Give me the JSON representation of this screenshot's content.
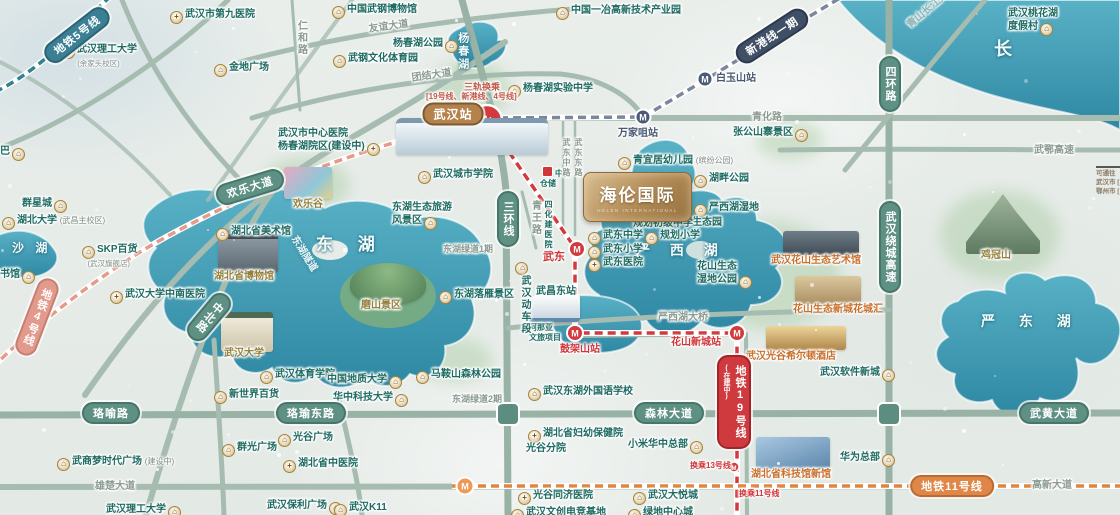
{
  "meta": {
    "width": 1120,
    "height": 515
  },
  "project_logo": {
    "name": "海伦国际",
    "subtitle": "HELEN INTERNATIONAL"
  },
  "legend": {
    "lines": [
      "可通往（",
      "武汉市 [",
      "鄂州市 ["
    ]
  },
  "lakes": [
    {
      "t": "东 湖",
      "x": 316,
      "y": 234,
      "sz": 17,
      "ls": 10
    },
    {
      "t": "沙 湖",
      "x": 12,
      "y": 241,
      "sz": 12,
      "ls": 4
    },
    {
      "t": "严 西 湖",
      "x": 636,
      "y": 242,
      "sz": 14,
      "ls": 8
    },
    {
      "t": "严 东 湖",
      "x": 981,
      "y": 313,
      "sz": 14,
      "ls": 10
    },
    {
      "t": "杨春湖",
      "x": 455,
      "y": 32,
      "sz": 11,
      "v": 1
    },
    {
      "t": "长",
      "x": 994,
      "y": 38,
      "sz": 18,
      "river": 1
    }
  ],
  "road_pills": [
    {
      "t": "欢乐大道",
      "x": 250,
      "y": 187,
      "r": -17
    },
    {
      "t": "三环线",
      "x": 508,
      "y": 219,
      "v": 1
    },
    {
      "t": "中北路",
      "x": 209,
      "y": 317,
      "v": 1,
      "r": 40
    },
    {
      "t": "珞喻路",
      "x": 111,
      "y": 413
    },
    {
      "t": "珞瑜东路",
      "x": 311,
      "y": 413
    },
    {
      "t": "森林大道",
      "x": 669,
      "y": 413
    },
    {
      "t": "武黄大道",
      "x": 1054,
      "y": 413
    },
    {
      "t": "四环路",
      "x": 890,
      "y": 84,
      "v": 1
    },
    {
      "t": "武汉绕城高速",
      "x": 890,
      "y": 247,
      "v": 1
    }
  ],
  "road_labels": [
    {
      "t": "友谊大道",
      "x": 368,
      "y": 24,
      "r": -8
    },
    {
      "t": "团结大道",
      "x": 411,
      "y": 73,
      "r": -8
    },
    {
      "t": "青化路",
      "x": 752,
      "y": 112
    },
    {
      "t": "仁和路",
      "x": 294,
      "y": 20,
      "v": 1
    },
    {
      "t": "青王路",
      "x": 528,
      "y": 200,
      "v": 1
    },
    {
      "t": "武东中路",
      "x": 561,
      "y": 138,
      "v": 1,
      "sz": 8
    },
    {
      "t": "武东东路",
      "x": 573,
      "y": 138,
      "v": 1,
      "sz": 8
    },
    {
      "t": "东湖绿道1期",
      "x": 443,
      "y": 244,
      "sz": 9
    },
    {
      "t": "东湖绿道2期",
      "x": 452,
      "y": 394,
      "sz": 9
    },
    {
      "t": "雄楚大道",
      "x": 95,
      "y": 481
    },
    {
      "t": "高新大道",
      "x": 1032,
      "y": 480
    },
    {
      "t": "武鄂高速",
      "x": 1034,
      "y": 145
    },
    {
      "t": "严西湖大桥",
      "x": 658,
      "y": 312
    },
    {
      "t": "青山长江大桥",
      "x": 905,
      "y": 22,
      "r": -40,
      "faint": 1
    },
    {
      "t": "东湖隧道",
      "x": 298,
      "y": 234,
      "r": 58,
      "tunnel": 1
    }
  ],
  "metro": {
    "line_pills": [
      {
        "t": "地铁5号线",
        "x": 77,
        "y": 35,
        "r": -38,
        "line": "l5"
      },
      {
        "t": "地铁4号线",
        "x": 37,
        "y": 317,
        "v": 1,
        "r": 21,
        "line": "l4"
      },
      {
        "t": "新港线一期",
        "x": 772,
        "y": 36,
        "r": -33,
        "line": "xg"
      },
      {
        "t": "地铁19号线",
        "sub": "(在建中)",
        "x": 734,
        "y": 402,
        "v": 1,
        "line": "l19"
      },
      {
        "t": "地铁11号线",
        "x": 952,
        "y": 486,
        "line": "l11"
      }
    ],
    "rail_station_pill": {
      "t": "武汉站",
      "x": 453,
      "y": 114
    },
    "transfer_note": {
      "t": "三轨换乘",
      "x": 464,
      "y": 82,
      "sub": "[19号线、新港线、4号线]",
      "sx": 426,
      "sy": 92
    },
    "stations": [
      {
        "t": "万家咀站",
        "x": 618,
        "y": 128,
        "c": "n"
      },
      {
        "t": "白玉山站",
        "x": 716,
        "y": 73,
        "c": "n"
      },
      {
        "t": "武东",
        "x": 543,
        "y": 251,
        "c": "r",
        "sz": 11
      },
      {
        "t": "鼓架山站",
        "x": 560,
        "y": 344,
        "c": "r"
      },
      {
        "t": "花山新城站",
        "x": 671,
        "y": 337,
        "c": "r"
      },
      {
        "t": "换乘13号线",
        "x": 690,
        "y": 461,
        "c": "r",
        "sz": 8
      },
      {
        "t": "换乘11号线",
        "x": 739,
        "y": 489,
        "c": "r",
        "sz": 8
      }
    ]
  },
  "pois": [
    {
      "t": "武汉市第九医院",
      "x": 168,
      "y": 9,
      "i": "h"
    },
    {
      "t": "武汉理工大学",
      "s": "(余家头校区)",
      "x": 60,
      "y": 44,
      "i": "b"
    },
    {
      "t": "金地广场",
      "x": 212,
      "y": 62,
      "i": "b"
    },
    {
      "t": "中国武钢博物馆",
      "x": 330,
      "y": 4,
      "i": "b"
    },
    {
      "t": "杨春湖公园",
      "x": 393,
      "y": 38,
      "i": "rb"
    },
    {
      "t": "武钢文化体育园",
      "x": 331,
      "y": 53,
      "i": "b"
    },
    {
      "t": "中国一冶高新技术产业园",
      "x": 554,
      "y": 5,
      "i": "b"
    },
    {
      "t": "杨春湖实验中学",
      "x": 506,
      "y": 83,
      "i": "b"
    },
    {
      "t": "张公山寨景区",
      "x": 733,
      "y": 127,
      "i": "rb"
    },
    {
      "t": "青宜居幼儿园",
      "suf": "(缤纷公园)",
      "x": 616,
      "y": 155,
      "i": "b"
    },
    {
      "t": "湖畔公园",
      "x": 692,
      "y": 173,
      "i": "b"
    },
    {
      "lines": [
        "严西湖湿地",
        "生态园"
      ],
      "x": 692,
      "y": 202,
      "i": "b"
    },
    {
      "t": "武东中学",
      "x": 586,
      "y": 230,
      "i": "b"
    },
    {
      "t": "规划小学",
      "x": 643,
      "y": 230,
      "i": "b"
    },
    {
      "t": "武东小学",
      "x": 586,
      "y": 244,
      "i": "b"
    },
    {
      "t": "武东医院",
      "x": 586,
      "y": 257,
      "i": "h"
    },
    {
      "t": "规划初级中学",
      "x": 633,
      "y": 218,
      "i": "n"
    },
    {
      "lines": [
        "花山生态",
        "湿地公园"
      ],
      "x": 697,
      "y": 261,
      "i": "rb"
    },
    {
      "t": "武汉花山生态艺术馆",
      "x": 771,
      "y": 255,
      "c": "o",
      "i": "n"
    },
    {
      "t": "花山生态新城花城汇",
      "x": 793,
      "y": 304,
      "c": "o",
      "i": "n"
    },
    {
      "t": "武汉光谷希尔顿酒店",
      "x": 746,
      "y": 351,
      "c": "o",
      "i": "n"
    },
    {
      "t": "武汉软件新城",
      "x": 820,
      "y": 367,
      "i": "rb"
    },
    {
      "t": "华为总部",
      "x": 840,
      "y": 452,
      "i": "rb"
    },
    {
      "t": "鸡冠山",
      "x": 981,
      "y": 250,
      "c": "g",
      "i": "n"
    },
    {
      "lines": [
        "武汉桃花湖",
        "度假村"
      ],
      "x": 1008,
      "y": 8,
      "i": "rb"
    },
    {
      "t": "群星城",
      "x": 22,
      "y": 198,
      "i": "rb"
    },
    {
      "t": "湖北大学",
      "suf": "(武昌主校区)",
      "x": 0,
      "y": 215,
      "i": "b"
    },
    {
      "t": "SKP百货",
      "s": "(武汉旗舰店)",
      "x": 80,
      "y": 244,
      "i": "b"
    },
    {
      "t": "武汉大学中南医院",
      "x": 108,
      "y": 289,
      "i": "h"
    },
    {
      "t": "湖北省美术馆",
      "x": 214,
      "y": 226,
      "i": "b"
    },
    {
      "t": "湖北省博物馆",
      "x": 214,
      "y": 271,
      "c": "g",
      "i": "n"
    },
    {
      "t": "武汉大学",
      "x": 224,
      "y": 348,
      "c": "g",
      "i": "n"
    },
    {
      "t": "欢乐谷",
      "x": 293,
      "y": 199,
      "c": "g",
      "i": "n"
    },
    {
      "t": "武汉城市学院",
      "x": 416,
      "y": 169,
      "i": "b"
    },
    {
      "lines": [
        "东湖生态旅游",
        "风景区"
      ],
      "x": 392,
      "y": 202,
      "i": "rb"
    },
    {
      "t": "东湖落雁景区",
      "x": 437,
      "y": 289,
      "i": "b"
    },
    {
      "t": "磨山景区",
      "x": 361,
      "y": 300,
      "c": "g",
      "i": "n"
    },
    {
      "t": "书馆",
      "x": 0,
      "y": 269,
      "i": "rb"
    },
    {
      "t": "巴",
      "x": 0,
      "y": 146,
      "i": "rb"
    },
    {
      "lines": [
        "武汉市中心医院",
        "杨春湖院区(建设中)"
      ],
      "x": 278,
      "y": 128,
      "i": "rh"
    },
    {
      "t": "武汉体育学院",
      "x": 258,
      "y": 369,
      "i": "b"
    },
    {
      "t": "中国地质大学",
      "x": 327,
      "y": 374,
      "i": "rb"
    },
    {
      "t": "华中科技大学",
      "x": 333,
      "y": 392,
      "i": "rb"
    },
    {
      "t": "马鞍山森林公园",
      "x": 414,
      "y": 369,
      "i": "b"
    },
    {
      "t": "新世界百货",
      "x": 212,
      "y": 389,
      "i": "b"
    },
    {
      "t": "群光广场",
      "x": 220,
      "y": 442,
      "i": "b"
    },
    {
      "t": "武商梦时代广场",
      "suf": "(建设中)",
      "x": 55,
      "y": 456,
      "i": "b"
    },
    {
      "t": "光谷广场",
      "x": 276,
      "y": 432,
      "i": "b"
    },
    {
      "t": "湖北省中医院",
      "x": 281,
      "y": 458,
      "i": "h"
    },
    {
      "t": "武汉保利广场",
      "x": 267,
      "y": 500,
      "i": "rb"
    },
    {
      "t": "武汉K11",
      "x": 332,
      "y": 502,
      "i": "b"
    },
    {
      "t": "武汉理工大学",
      "x": 106,
      "y": 504,
      "i": "rb"
    },
    {
      "t": "武汉东湖外国语学校",
      "x": 526,
      "y": 386,
      "i": "b"
    },
    {
      "lines": [
        "湖北省妇幼保健院",
        "光谷分院"
      ],
      "x": 526,
      "y": 428,
      "i": "h"
    },
    {
      "t": "小米华中总部",
      "x": 628,
      "y": 439,
      "i": "rb"
    },
    {
      "t": "湖北省科技馆新馆",
      "x": 751,
      "y": 469,
      "c": "o",
      "i": "n"
    },
    {
      "t": "光谷同济医院",
      "x": 516,
      "y": 490,
      "i": "h"
    },
    {
      "t": "武汉大悦城",
      "x": 631,
      "y": 490,
      "i": "b"
    },
    {
      "t": "武汉文创电竞基地",
      "x": 509,
      "y": 507,
      "i": "b"
    },
    {
      "t": "绿地中心城",
      "x": 626,
      "y": 507,
      "i": "b"
    },
    {
      "lines": [
        "阿那亚",
        "文旅项目"
      ],
      "x": 529,
      "y": 323,
      "i": "n",
      "sz": 8
    },
    {
      "t": "武昌东站",
      "x": 536,
      "y": 286,
      "i": "n"
    },
    {
      "t": "武汉动车段",
      "x": 513,
      "y": 262,
      "v": 1,
      "i": "b"
    },
    {
      "lines": [
        "中百",
        "仓储"
      ],
      "x": 540,
      "y": 166,
      "i": "sq",
      "sz": 8
    },
    {
      "t": "四化建医院",
      "x": 543,
      "y": 200,
      "v": 1,
      "sz": 8,
      "i": "n"
    }
  ],
  "illustrations": [
    {
      "name": "wuhan-station-building",
      "type": "station",
      "x": 396,
      "y": 118,
      "w": 152,
      "h": 32
    },
    {
      "name": "hubei-museum-building",
      "type": "museum",
      "x": 218,
      "y": 234,
      "w": 60,
      "h": 34
    },
    {
      "name": "wuhan-university-gate",
      "type": "gate",
      "x": 221,
      "y": 312,
      "w": 52,
      "h": 34
    },
    {
      "name": "happy-valley-park",
      "type": "fun",
      "x": 284,
      "y": 167,
      "w": 48,
      "h": 32
    },
    {
      "name": "moshan-hill",
      "type": "hill",
      "x": 350,
      "y": 263,
      "w": 76,
      "h": 42
    },
    {
      "name": "bullet-train",
      "type": "train",
      "x": 528,
      "y": 294,
      "w": 52,
      "h": 24
    },
    {
      "name": "science-museum-building",
      "type": "blue",
      "x": 756,
      "y": 437,
      "w": 74,
      "h": 32
    },
    {
      "name": "hilton-hotel-building",
      "type": "gold",
      "x": 766,
      "y": 326,
      "w": 80,
      "h": 24
    },
    {
      "name": "huashan-art-museum-building",
      "type": "dark",
      "x": 783,
      "y": 231,
      "w": 76,
      "h": 24
    },
    {
      "name": "huachenghui-building",
      "type": "tan",
      "x": 795,
      "y": 276,
      "w": 66,
      "h": 28
    },
    {
      "name": "jiguanshan-mountain",
      "type": "mountain",
      "x": 966,
      "y": 194,
      "w": 74,
      "h": 60
    }
  ]
}
